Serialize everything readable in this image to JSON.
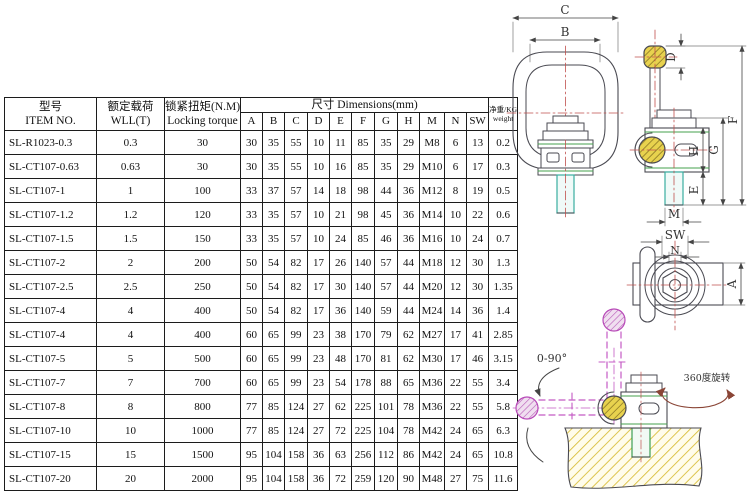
{
  "table": {
    "headers": {
      "item_no_zh": "型号",
      "item_no_en": "ITEM NO.",
      "wll_zh": "额定载荷",
      "wll_en": "WLL(T)",
      "torque_zh": "锁紧扭矩(N.M)",
      "torque_en": "Locking torque",
      "dims_group": "尺寸  Dimensions(mm)",
      "dim_cols": [
        "A",
        "B",
        "C",
        "D",
        "E",
        "F",
        "G",
        "H",
        "M",
        "N",
        "SW"
      ],
      "weight_zh": "净重/KG",
      "weight_en": "weight"
    },
    "rows": [
      {
        "item": "SL-R1023-0.3",
        "wll": "0.3",
        "torque": "30",
        "dims": [
          "30",
          "35",
          "55",
          "10",
          "11",
          "85",
          "35",
          "29",
          "M8",
          "6",
          "13"
        ],
        "weight": "0.2"
      },
      {
        "item": "SL-CT107-0.63",
        "wll": "0.63",
        "torque": "30",
        "dims": [
          "30",
          "35",
          "55",
          "10",
          "16",
          "85",
          "35",
          "29",
          "M10",
          "6",
          "17"
        ],
        "weight": "0.3"
      },
      {
        "item": "SL-CT107-1",
        "wll": "1",
        "torque": "100",
        "dims": [
          "33",
          "37",
          "57",
          "14",
          "18",
          "98",
          "44",
          "36",
          "M12",
          "8",
          "19"
        ],
        "weight": "0.5"
      },
      {
        "item": "SL-CT107-1.2",
        "wll": "1.2",
        "torque": "120",
        "dims": [
          "33",
          "35",
          "57",
          "10",
          "21",
          "98",
          "45",
          "36",
          "M14",
          "10",
          "22"
        ],
        "weight": "0.6"
      },
      {
        "item": "SL-CT107-1.5",
        "wll": "1.5",
        "torque": "150",
        "dims": [
          "33",
          "35",
          "57",
          "10",
          "24",
          "85",
          "46",
          "36",
          "M16",
          "10",
          "24"
        ],
        "weight": "0.7"
      },
      {
        "item": "SL-CT107-2",
        "wll": "2",
        "torque": "200",
        "dims": [
          "50",
          "54",
          "82",
          "17",
          "26",
          "140",
          "57",
          "44",
          "M18",
          "12",
          "30"
        ],
        "weight": "1.3"
      },
      {
        "item": "SL-CT107-2.5",
        "wll": "2.5",
        "torque": "250",
        "dims": [
          "50",
          "54",
          "82",
          "17",
          "30",
          "140",
          "57",
          "44",
          "M20",
          "12",
          "30"
        ],
        "weight": "1.35"
      },
      {
        "item": "SL-CT107-4",
        "wll": "4",
        "torque": "400",
        "dims": [
          "50",
          "54",
          "82",
          "17",
          "36",
          "140",
          "59",
          "44",
          "M24",
          "14",
          "36"
        ],
        "weight": "1.4"
      },
      {
        "item": "SL-CT107-4",
        "wll": "4",
        "torque": "400",
        "dims": [
          "60",
          "65",
          "99",
          "23",
          "38",
          "170",
          "79",
          "62",
          "M27",
          "17",
          "41"
        ],
        "weight": "2.85"
      },
      {
        "item": "SL-CT107-5",
        "wll": "5",
        "torque": "500",
        "dims": [
          "60",
          "65",
          "99",
          "23",
          "48",
          "170",
          "81",
          "62",
          "M30",
          "17",
          "46"
        ],
        "weight": "3.15"
      },
      {
        "item": "SL-CT107-7",
        "wll": "7",
        "torque": "700",
        "dims": [
          "60",
          "65",
          "99",
          "23",
          "54",
          "178",
          "88",
          "65",
          "M36",
          "22",
          "55"
        ],
        "weight": "3.4"
      },
      {
        "item": "SL-CT107-8",
        "wll": "8",
        "torque": "800",
        "dims": [
          "77",
          "85",
          "124",
          "27",
          "62",
          "225",
          "101",
          "78",
          "M36",
          "22",
          "55"
        ],
        "weight": "5.8"
      },
      {
        "item": "SL-CT107-10",
        "wll": "10",
        "torque": "1000",
        "dims": [
          "77",
          "85",
          "124",
          "27",
          "72",
          "225",
          "104",
          "78",
          "M42",
          "24",
          "65"
        ],
        "weight": "6.3"
      },
      {
        "item": "SL-CT107-15",
        "wll": "15",
        "torque": "1500",
        "dims": [
          "95",
          "104",
          "158",
          "36",
          "63",
          "256",
          "112",
          "86",
          "M42",
          "24",
          "65"
        ],
        "weight": "10.8"
      },
      {
        "item": "SL-CT107-20",
        "wll": "20",
        "torque": "2000",
        "dims": [
          "95",
          "104",
          "158",
          "36",
          "72",
          "259",
          "120",
          "90",
          "M48",
          "27",
          "75"
        ],
        "weight": "11.6"
      }
    ]
  },
  "drawing": {
    "labels": {
      "c": "C",
      "b": "B",
      "d": "D",
      "f": "F",
      "g": "G",
      "h": "H",
      "e": "E",
      "m": "M",
      "sw": "SW",
      "n": "N",
      "a": "A",
      "tilt": "0-90°",
      "rotate": "360度旋转"
    },
    "colors": {
      "outline": "#4a4a52",
      "center_line": "#c0504d",
      "bolt_teal": "#3aada0",
      "highlight_green": "#44a04c",
      "hatch_yellow": "#e8d24e",
      "ghost_magenta": "#c45ac4",
      "arrow_brown": "#8a4536"
    }
  }
}
